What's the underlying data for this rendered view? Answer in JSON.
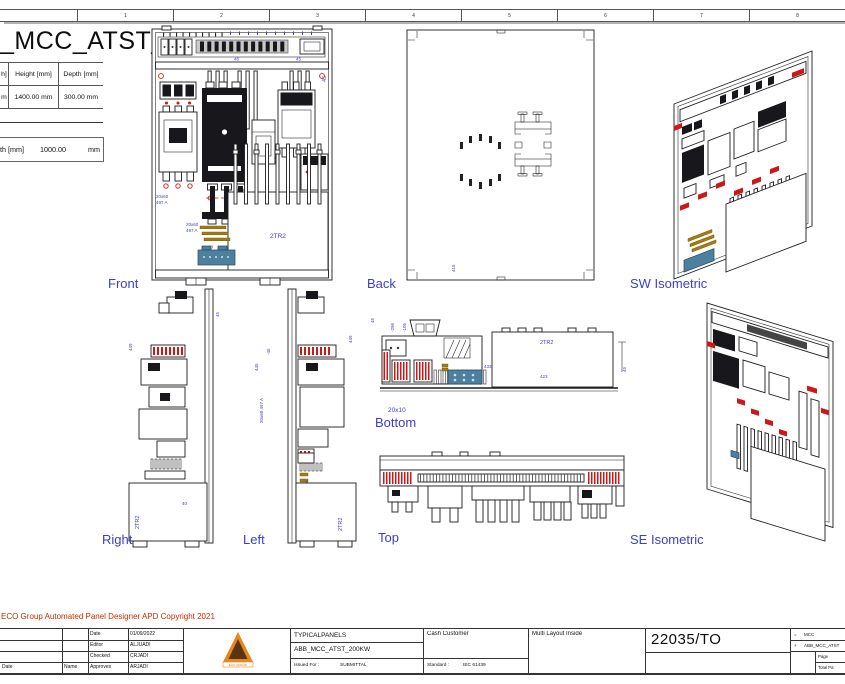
{
  "ruler": {
    "cells": [
      "",
      "1",
      "2",
      "3",
      "4",
      "5",
      "6",
      "7",
      "8"
    ]
  },
  "header": {
    "drawing_title": "_MCC_ATST_200KW",
    "dims_table": {
      "col1_header": "h]",
      "col2_header": "Height [mm]",
      "col3_header": "Depth [mm]",
      "col1_value": "m",
      "col2_value": "1400.00 mm",
      "col3_value": "300.00 mm"
    },
    "width_field": {
      "label": "th [mm]",
      "value": "1000.00",
      "unit": "mm"
    }
  },
  "views": {
    "front": {
      "label": "Front",
      "ann": {
        "dim_a": "46",
        "dim_b": "45",
        "dim_side": "45",
        "bus1_l1": "20x60",
        "bus1_l2": "497 A",
        "bus2_l1": "20x60",
        "bus2_l2": "497 A",
        "tr": "2TR2",
        "device": "ABB_MCC_ATST",
        "dim_c": "40"
      }
    },
    "back": {
      "label": "Back",
      "ann": {
        "dim_a": "415"
      }
    },
    "sw_iso": {
      "label": "SW Isometric"
    },
    "right": {
      "label": "Right",
      "ann": {
        "dim_a": "449",
        "dim_b": "45",
        "tr": "2TR2",
        "dim_c": "40"
      }
    },
    "left": {
      "label": "Left",
      "ann": {
        "dim_a": "445",
        "dim_b": "-45",
        "bus1": "20x60 497 A",
        "bus2": "20x60 497 A",
        "tr": "2TR2",
        "dim_c": "449",
        "dim_d": "45"
      }
    },
    "bottom": {
      "label": "Bottom",
      "sublabel": "20x10",
      "ann": {
        "tr": "2TR2",
        "dim_a": "423",
        "dim_b": "433",
        "dim_c": "45",
        "rot1": "-296",
        "rot2": "-105",
        "rot3": "-274",
        "rot4": "-204"
      }
    },
    "top": {
      "label": "Top"
    },
    "se_iso": {
      "label": "SE Isometric"
    }
  },
  "footer": {
    "copyright": "ECO Group Automated Panel Designer APD Copyright 2021",
    "title_block": {
      "rev_date_label": "Date",
      "rev_name_label": "Name",
      "signoff": [
        {
          "label": "Date",
          "value": "01/09/2022"
        },
        {
          "label": "Editor",
          "value": "ALJUADI"
        },
        {
          "label": "Checked",
          "value": "CRJADI"
        },
        {
          "label": "Approves",
          "value": "ARJADI"
        }
      ],
      "logo_caption": "ECO GROUP",
      "project_line1": "TYPICALPANELS",
      "project_line2": "ABB_MCC_ATST_200KW",
      "issued_label": "Issued For :",
      "issued_value": "SUBMITTAL",
      "standard_label": "Standard :",
      "standard_value": "IEC 61439",
      "customer": "Cash Customer",
      "layout_note": "Multi Layout Inside",
      "drawing_number": "22035/TO",
      "ref_function": "=",
      "ref_function_value": "MCC",
      "ref_location": "+",
      "ref_location_value": "ABB_MCC_ATST",
      "page_label": "Page",
      "total_label": "Total Pa"
    }
  }
}
